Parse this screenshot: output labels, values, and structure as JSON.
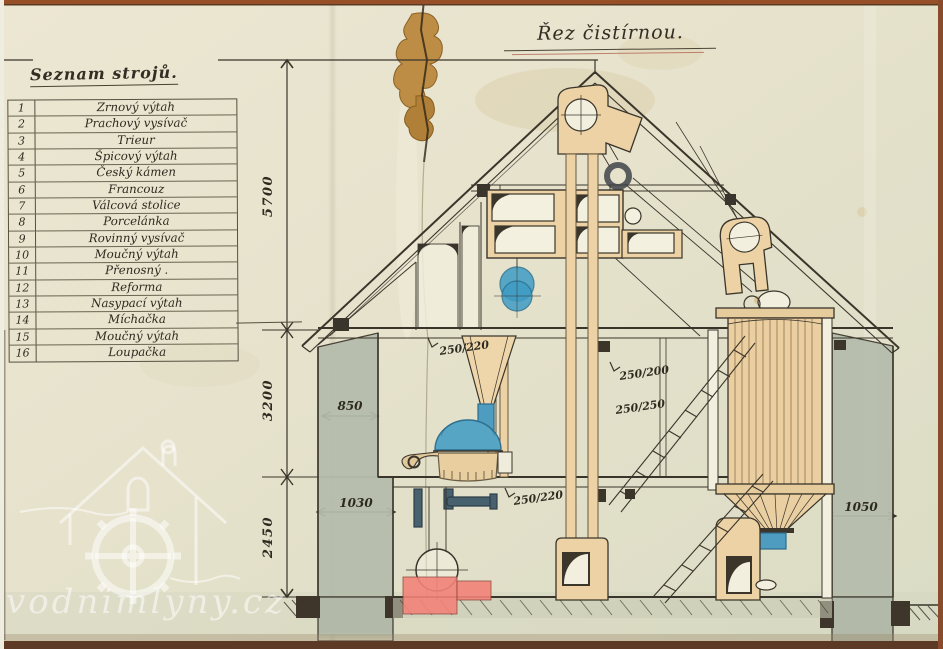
{
  "title": {
    "text": "Řez čistírnou."
  },
  "machine_list": {
    "header": "Seznam strojů.",
    "items": [
      {
        "num": "1",
        "name": "Zrnový výtah"
      },
      {
        "num": "2",
        "name": "Prachový vysívač"
      },
      {
        "num": "3",
        "name": "Trieur"
      },
      {
        "num": "4",
        "name": "Špicový výtah"
      },
      {
        "num": "5",
        "name": "Český kámen"
      },
      {
        "num": "6",
        "name": "Francouz"
      },
      {
        "num": "7",
        "name": "Válcová stolice"
      },
      {
        "num": "8",
        "name": "Porcelánka"
      },
      {
        "num": "9",
        "name": "Rovinný vysívač"
      },
      {
        "num": "10",
        "name": "Moučný výtah"
      },
      {
        "num": "11",
        "name": "Přenosný ."
      },
      {
        "num": "12",
        "name": "Reforma"
      },
      {
        "num": "13",
        "name": "Nasypací výtah"
      },
      {
        "num": "14",
        "name": "Míchačka"
      },
      {
        "num": "15",
        "name": "Moučný výtah"
      },
      {
        "num": "16",
        "name": "Loupačka"
      }
    ]
  },
  "dimensions": {
    "attic_height": "5700",
    "first_floor_height": "3200",
    "ground_floor_height": "2450",
    "wall_thickness_upper": "850",
    "wall_thickness_lower_left": "1030",
    "wall_thickness_lower_right": "1050",
    "beam_upper_left": "250/220",
    "beam_right_a": "250/200",
    "beam_right_b": "250/250",
    "beam_lower": "250/220"
  },
  "watermark": {
    "text": "vodnimlyny.cz"
  },
  "colors": {
    "paper": "#e6e2cc",
    "ink": "#3a352b",
    "wood_tan": "#ecd2a4",
    "machine_blue": "#4e9dc0",
    "foundation_red": "#f28379",
    "wall_grey": "#b5bcab"
  }
}
